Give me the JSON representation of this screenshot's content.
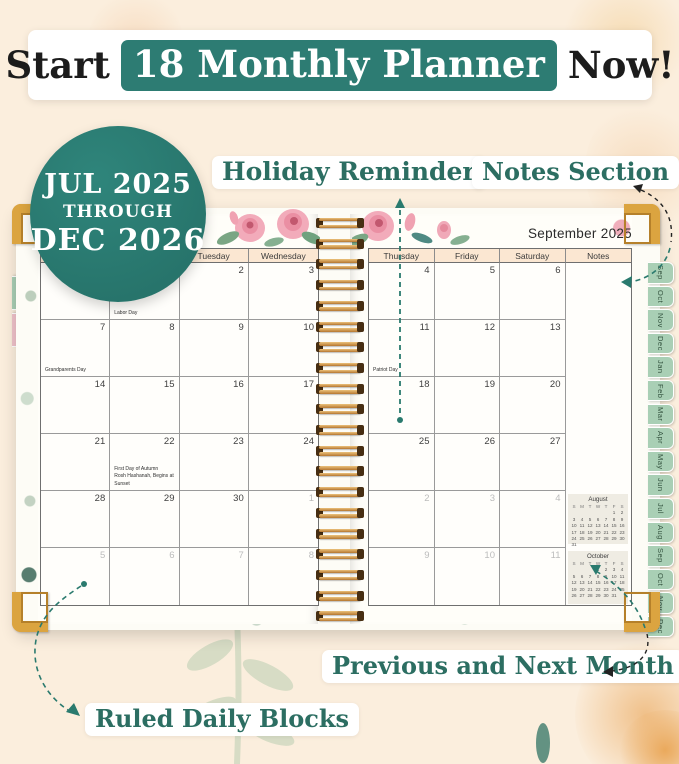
{
  "banner": {
    "prefix": "Start",
    "highlight": "18 Monthly Planner",
    "suffix": "Now!"
  },
  "badge": {
    "line1": "JUL 2025",
    "line2": "THROUGH",
    "line3": "DEC 2026"
  },
  "callouts": {
    "holiday_reminder": "Holiday Reminder",
    "notes_section": "Notes Section",
    "previous_next": "Previous and Next Month",
    "ruled_daily": "Ruled Daily Blocks"
  },
  "planner": {
    "month_title": "September 2025",
    "left_tabs": [
      {
        "label": "Jul",
        "color": "#a9cfb5"
      },
      {
        "label": "Aug",
        "color": "#f0c2ca"
      }
    ],
    "right_tabs": [
      "Sep",
      "Oct",
      "Nov",
      "Dec",
      "Jan",
      "Feb",
      "Mar",
      "Apr",
      "May",
      "Jun",
      "Jul",
      "Aug",
      "Sep",
      "Oct",
      "Nov",
      "Dec"
    ],
    "left_page": {
      "weekday_headers": [
        "",
        "",
        "Tuesday",
        "Wednesday"
      ],
      "rows": [
        [
          {
            "day": ""
          },
          {
            "day": "1",
            "holidays": [
              "Labor Day"
            ]
          },
          {
            "day": "2"
          },
          {
            "day": "3"
          }
        ],
        [
          {
            "day": "7",
            "holidays": [
              "Grandparents Day"
            ]
          },
          {
            "day": "8"
          },
          {
            "day": "9"
          },
          {
            "day": "10"
          }
        ],
        [
          {
            "day": "14"
          },
          {
            "day": "15"
          },
          {
            "day": "16"
          },
          {
            "day": "17"
          }
        ],
        [
          {
            "day": "21"
          },
          {
            "day": "22",
            "holidays": [
              "First Day of Autumn",
              "Rosh Hashanah, Begins at Sunset"
            ]
          },
          {
            "day": "23"
          },
          {
            "day": "24"
          }
        ],
        [
          {
            "day": "28"
          },
          {
            "day": "29"
          },
          {
            "day": "30"
          },
          {
            "day": "1",
            "gray": true
          }
        ],
        [
          {
            "day": "5",
            "gray": true
          },
          {
            "day": "6",
            "gray": true
          },
          {
            "day": "7",
            "gray": true
          },
          {
            "day": "8",
            "gray": true
          }
        ]
      ]
    },
    "right_page": {
      "weekday_headers": [
        "Thursday",
        "Friday",
        "Saturday",
        "Notes"
      ],
      "notes_column": true,
      "rows": [
        [
          {
            "day": "4"
          },
          {
            "day": "5"
          },
          {
            "day": "6"
          }
        ],
        [
          {
            "day": "11",
            "holidays": [
              "Patriot Day"
            ]
          },
          {
            "day": "12"
          },
          {
            "day": "13"
          }
        ],
        [
          {
            "day": "18"
          },
          {
            "day": "19"
          },
          {
            "day": "20"
          }
        ],
        [
          {
            "day": "25"
          },
          {
            "day": "26"
          },
          {
            "day": "27"
          }
        ],
        [
          {
            "day": "2",
            "gray": true
          },
          {
            "day": "3",
            "gray": true
          },
          {
            "day": "4",
            "gray": true
          }
        ],
        [
          {
            "day": "9",
            "gray": true
          },
          {
            "day": "10",
            "gray": true
          },
          {
            "day": "11",
            "gray": true
          }
        ]
      ],
      "mini_calendars": [
        {
          "title": "August",
          "dow": [
            "S",
            "M",
            "T",
            "W",
            "T",
            "F",
            "S"
          ],
          "weeks": [
            [
              "",
              "",
              "",
              "",
              "",
              "1",
              "2"
            ],
            [
              "3",
              "4",
              "5",
              "6",
              "7",
              "8",
              "9"
            ],
            [
              "10",
              "11",
              "12",
              "13",
              "14",
              "15",
              "16"
            ],
            [
              "17",
              "18",
              "19",
              "20",
              "21",
              "22",
              "23"
            ],
            [
              "24",
              "25",
              "26",
              "27",
              "28",
              "29",
              "30"
            ],
            [
              "31",
              "",
              "",
              "",
              "",
              "",
              ""
            ]
          ]
        },
        {
          "title": "October",
          "dow": [
            "S",
            "M",
            "T",
            "W",
            "T",
            "F",
            "S"
          ],
          "weeks": [
            [
              "",
              "",
              "",
              "1",
              "2",
              "3",
              "4"
            ],
            [
              "5",
              "6",
              "7",
              "8",
              "9",
              "10",
              "11"
            ],
            [
              "12",
              "13",
              "14",
              "15",
              "16",
              "17",
              "18"
            ],
            [
              "19",
              "20",
              "21",
              "22",
              "23",
              "24",
              "25"
            ],
            [
              "26",
              "27",
              "28",
              "29",
              "30",
              "31",
              ""
            ]
          ]
        }
      ]
    }
  },
  "colors": {
    "teal": "#2d7c73",
    "callout_text": "#2c6e62",
    "header_fill": "#fbe7d2",
    "tab_green": "#a9cfb5",
    "tab_pink": "#f0c2ca",
    "gold": "#dba440",
    "gray_date": "#bcbcbc",
    "spiral_copper": "#c08040",
    "arrow_teal": "#2a7a6e"
  }
}
